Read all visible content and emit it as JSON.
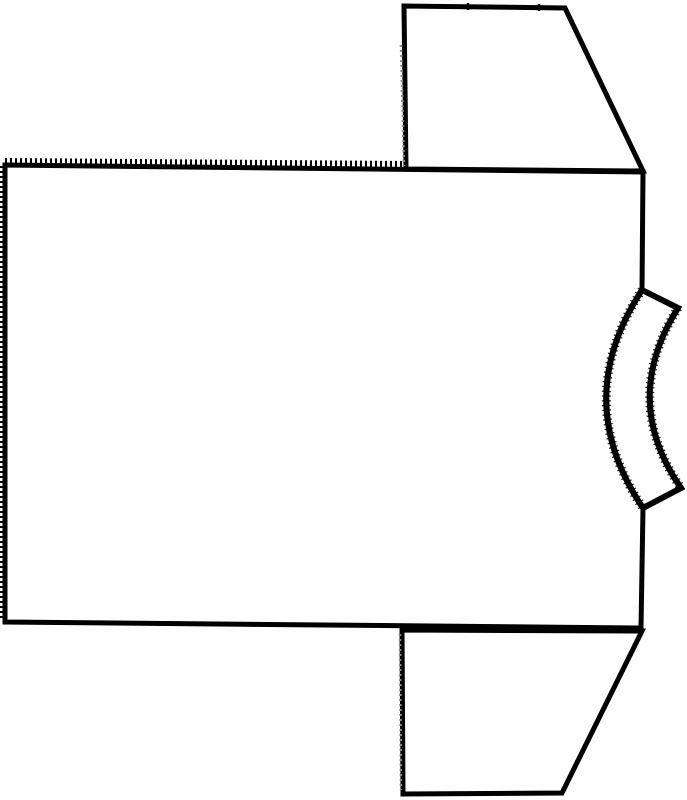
{
  "drawing": {
    "description": "Black ink line drawing of a short-sleeved T-shirt flat pattern lying on its side, neckline band facing right, with serrated (pinked) top and left edges of the body panel",
    "background_color": "#ffffff",
    "ink_color": "#000000",
    "seam_dot_color": "#8a8a8a",
    "canvas": {
      "width": "687",
      "height": "800",
      "viewbox": "0 0 687 800"
    },
    "shapes": {
      "body_panel": "M 5 165 L 643 172 L 642 290 Q 570 400 643 508 L 641 628 L 5 622 Z",
      "collar_band": "M 642 290 L 678 308 Q 620 400 681 488 L 643 508 Q 570 400 642 290 Z",
      "top_sleeve": "M 406 169 L 404 6 L 565 8 L 643 171 Z",
      "bottom_sleeve": "M 402 630 L 403 794 L 562 793 L 642 631 Z"
    },
    "textures": {
      "top_edge_serration": "M 5 161 L 404 164",
      "left_edge_serration": "M 3 166 L 2 621",
      "collar_outer_fuzz": "M 642 290 Q 570 400 643 508",
      "collar_inner_fuzz": "M 678 308 Q 620 400 681 488",
      "top_sleeve_seam_dots": "M 401 45 L 404 166",
      "bottom_sleeve_seam_dots": "M 400 634 L 401 790",
      "top_sleeve_tick_1": "M 468 3 L 468 10",
      "top_sleeve_tick_2": "M 539 4 L 539 11"
    }
  }
}
